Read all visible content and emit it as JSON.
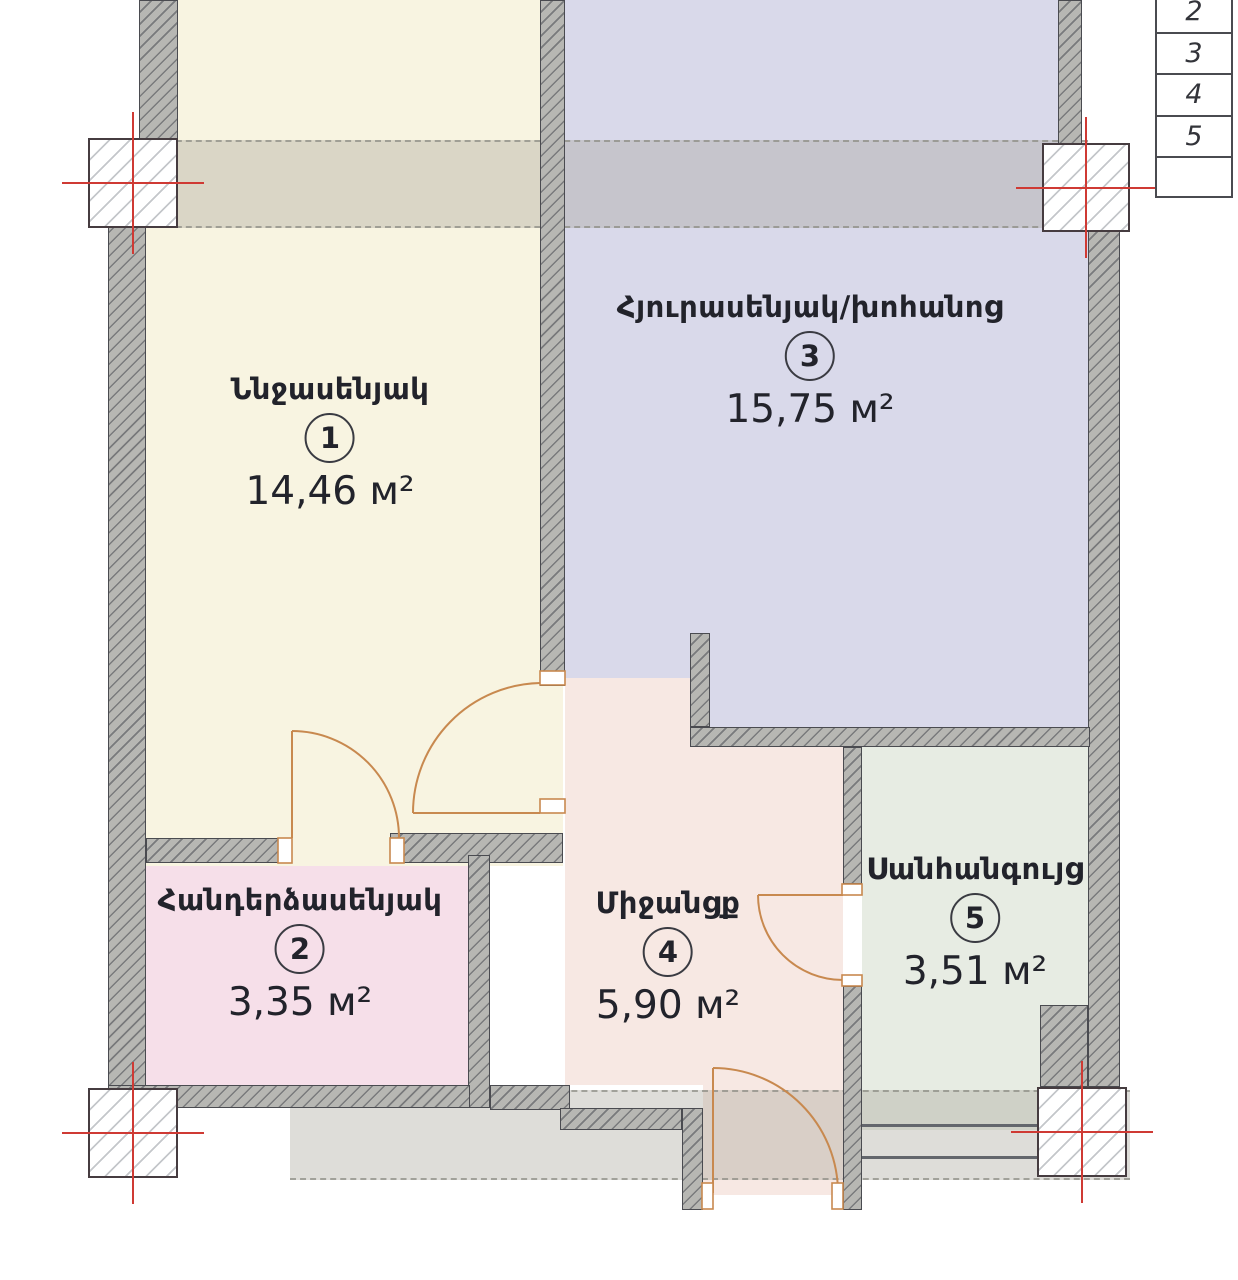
{
  "plan": {
    "title": "apartment-floor-plan",
    "rooms": [
      {
        "name": "Ննջասենյակ",
        "number": "1",
        "area": "14,46 м²",
        "color": "#f8f4e1"
      },
      {
        "name": "Հանդերձասենյակ",
        "number": "2",
        "area": "3,35 м²",
        "color": "#f6dfe9"
      },
      {
        "name": "Հյուրասենյակ/խոհանոց",
        "number": "3",
        "area": "15,75 м²",
        "color": "#d9d9ea"
      },
      {
        "name": "Միջանցք",
        "number": "4",
        "area": "5,90 м²",
        "color": "#f7e8e3"
      },
      {
        "name": "Սանհանգույց",
        "number": "5",
        "area": "3,51 м²",
        "color": "#e7ece3"
      }
    ],
    "axis_table": {
      "rows": [
        "2",
        "3",
        "4",
        "5",
        ""
      ]
    },
    "colors": {
      "wall": "#b7b7b3",
      "wall_outline": "#4a4b50",
      "door": "#c8894f",
      "axis_cross": "#cf3a34",
      "slab_band": "rgba(168,166,156,0.38)",
      "room1_fill": "#f8f4e1",
      "room2_fill": "#f6dfe9",
      "room3_fill": "#d9d9ea",
      "room4_fill": "#f7e8e3",
      "room5_fill": "#e7ece3"
    }
  }
}
